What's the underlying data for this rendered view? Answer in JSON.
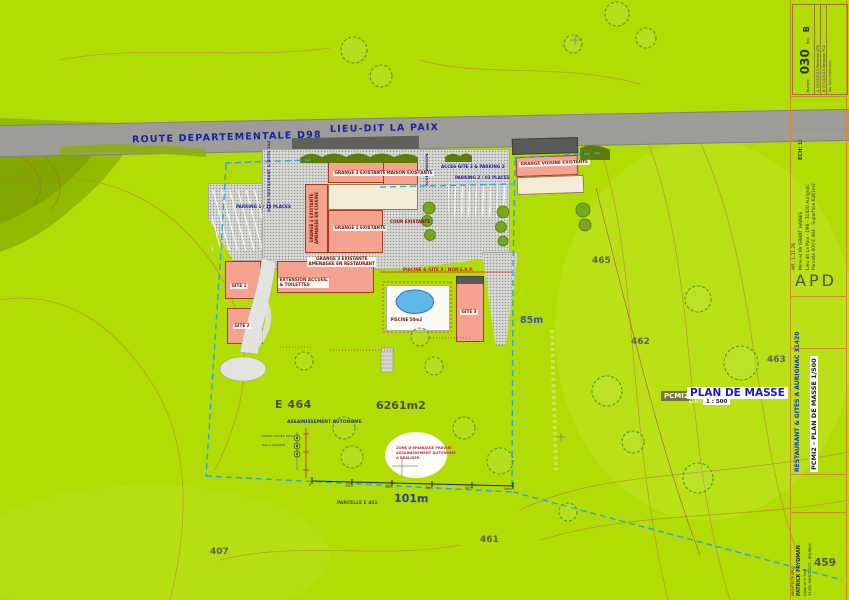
{
  "road": {
    "route": "ROUTE  DEPARTEMENTALE  D98",
    "lieu_dit": "LIEU-DIT  LA  PAIX"
  },
  "access": {
    "restaurant": "ACCES RESTAURANT & GITES 1&2",
    "maison": "ACCES MAISON",
    "gite3": "ACCES GITE 3 & PARKING 2",
    "parking1": "PARKING 1 / 15 PLACES",
    "parking2": "PARKING 2 / 03 PLACES"
  },
  "buildings": {
    "grange2": "GRANGE 2 EXISTANTE",
    "maison": "MAISON EXISTANTE",
    "voisine": "GRANGE VOISINE EXISTANTE",
    "grange4_l1": "GRANGE 4 EXISTANTE",
    "grange4_l2": "AMENAGEE EN CUISINE",
    "grange1": "GRANGE 1 EXISTANTE",
    "cour": "COUR EXISTANTE",
    "grange3_l1": "GRANGE 3 EXISTANTE",
    "grange3_l2": "AMENAGEE EN RESTAURANT",
    "ext_l1": "EXTENSION ACCUEIL",
    "ext_l2": "& TOILETTES",
    "gite1": "GITE 1",
    "gite2": "GITE 2",
    "gite3": "GITE 3"
  },
  "pool": {
    "label": "PISCINE 50m2",
    "note": "PISCINE & GITE 3 : NON E.R.P."
  },
  "site": {
    "parcel_ref": "E 464",
    "area": "6261m2",
    "assainissement": "ASSAINISSEMENT  AUTONOME",
    "legend_l1": "FOSSE TOUTES EAUX",
    "legend_l2": "BAC A GRAISSE",
    "epandage_l1": "ZONE D'EPANDAGE PREVUE",
    "epandage_l2": "ASSAINISSEMENT AUTONOME",
    "epandage_l3": "A REALISER",
    "parcelle_sud": "PARCELLE    E 461",
    "dim_width": "101m",
    "dim_height": "85m",
    "parcels": {
      "p465": "465",
      "p462": "462",
      "p463": "463",
      "p461": "461",
      "p407": "407",
      "p459": "459"
    }
  },
  "scalebar": {
    "t0": "0",
    "t10": "10m",
    "t20": "20m",
    "t30": "30m",
    "t40": "40m",
    "t50": "50m"
  },
  "legend": {
    "code": "PCMI2",
    "title": "PLAN DE MASSE",
    "ech_label": "Ech :",
    "scale": "1 : 500"
  },
  "titleblock": {
    "numero_label": "Numero",
    "numero": "030",
    "rev_label": "Rév.",
    "rev": "B",
    "rev_header": "Rév.   Date   Modification",
    "rev_a": "A   19/02/2015   Emission APD",
    "rev_b": "B   07/10/2015   Emission PC2",
    "ech": "ECH: 1/",
    "aff": "Aff.: 1.31.76",
    "client": "Mme et Mr GRANT HAINES",
    "adresse": "Lieu dit La Paix - D98 - 31420 Aurignac",
    "parcelle": "Parcelle 000 E 464 - Superficie 6261m2",
    "phase": "APD",
    "project": "RESTAURANT & GITES A AURIGNAC 31420",
    "doc": "PCMI2 - PLAN DE MASSE 1/500",
    "arch1": "ARCHITECTE DPLG",
    "arch2": "PATRICK FRYDMAN",
    "arch3": "Camp de la Salle",
    "arch4": "31430 MONTEGUT - BOURJAC"
  },
  "colors": {
    "terrain": "#b1dc04",
    "building": "#f5a38f",
    "boundary": "#2aa7e8",
    "road": "#9d9c99",
    "annotation_red": "#c3151b",
    "label_navy": "#1b1f9e"
  }
}
